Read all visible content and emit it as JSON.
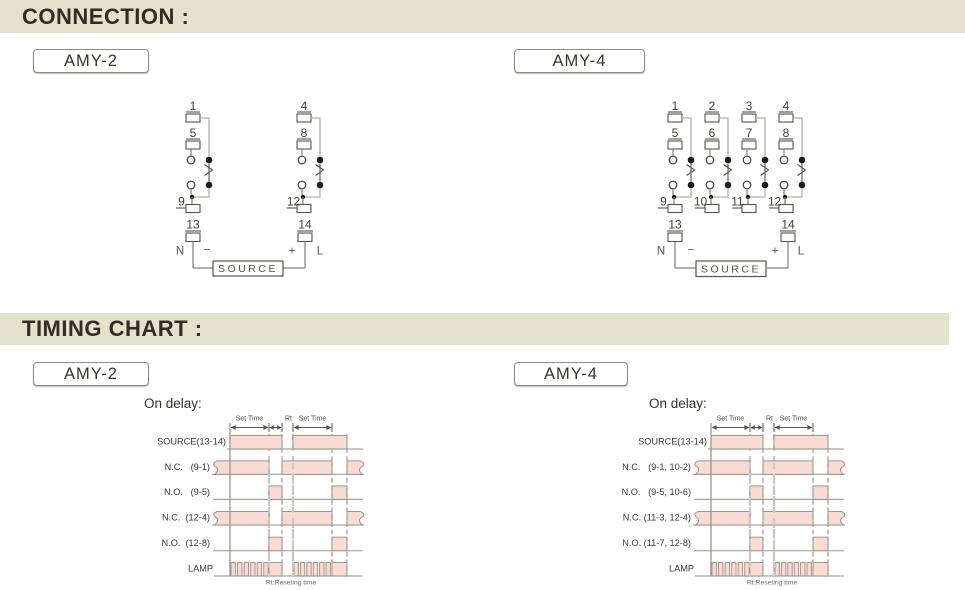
{
  "colors": {
    "page-bg": "#ffffff",
    "bar-bg": "#e4e1cc",
    "title-color": "#332c26",
    "pulse-fill": "#f8dcd4",
    "pulse-stroke": "#a2938c",
    "diagram-dark": "#57504b",
    "wire-light": "#b4ada6",
    "wire-med": "#847d77",
    "baseline": "#aaa49d"
  },
  "headers": {
    "connection": "CONNECTION :",
    "timing": "TIMING CHART :"
  },
  "models": {
    "amy2": "AMY-2",
    "amy4": "AMY-4"
  },
  "connection": {
    "amy2": {
      "poles": [
        {
          "top": "1",
          "mid": "5",
          "bot": "9"
        },
        {
          "top": "4",
          "mid": "8",
          "bot": "12"
        }
      ],
      "term_left": "13",
      "term_right": "14",
      "n": "N",
      "minus": "−",
      "plus": "+",
      "l": "L",
      "source": "SOURCE"
    },
    "amy4": {
      "poles": [
        {
          "top": "1",
          "mid": "5",
          "bot": "9"
        },
        {
          "top": "2",
          "mid": "6",
          "bot": "10"
        },
        {
          "top": "3",
          "mid": "7",
          "bot": "11"
        },
        {
          "top": "4",
          "mid": "8",
          "bot": "12"
        }
      ],
      "term_left": "13",
      "term_right": "14",
      "n": "N",
      "minus": "−",
      "plus": "+",
      "l": "L",
      "source": "SOURCE"
    }
  },
  "timing": {
    "subtitle": "On delay:",
    "set_time": "Set Time",
    "rt": "Rt",
    "footnote": "Rt:Reseting time",
    "amy2_rows": {
      "source": "SOURCE(13-14)",
      "nc1": "N.C.   (9-1)",
      "no1": "N.O.   (9-5)",
      "nc2": "N.C.  (12-4)",
      "no2": "N.O.  (12-8)",
      "lamp": "LAMP"
    },
    "amy4_rows": {
      "source": "SOURCE(13-14)",
      "nc1": "N.C.   (9-1, 10-2)",
      "no1": "N.O.   (9-5, 10-6)",
      "nc2": "N.C. (11-3, 12-4)",
      "no2": "N.O. (11-7, 12-8)",
      "lamp": "LAMP"
    }
  }
}
